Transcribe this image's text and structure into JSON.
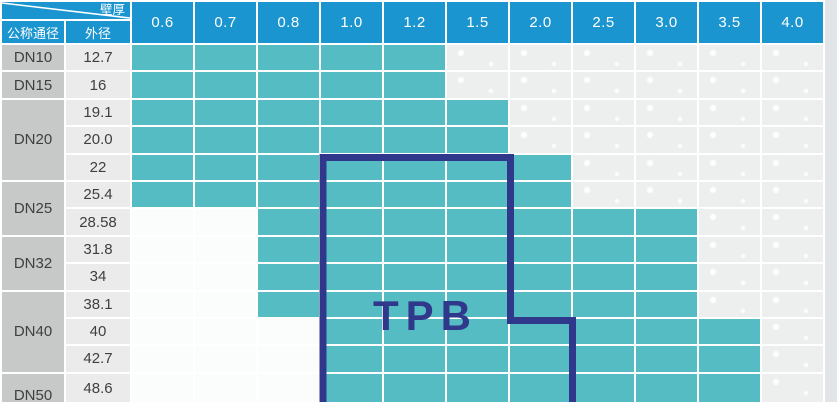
{
  "header": {
    "corner": {
      "diagonal_top_label": "壁厚",
      "col1_label": "公称通径",
      "col2_label": "外径"
    },
    "thickness_values": [
      "0.6",
      "0.7",
      "0.8",
      "1.0",
      "1.2",
      "1.5",
      "2.0",
      "2.5",
      "3.0",
      "3.5",
      "4.0"
    ]
  },
  "body": {
    "groups": [
      {
        "dn": "DN10",
        "rows": [
          {
            "od": "12.7",
            "available_from": "0.6",
            "available_to": "1.2"
          }
        ]
      },
      {
        "dn": "DN15",
        "rows": [
          {
            "od": "16",
            "available_from": "0.6",
            "available_to": "1.2"
          }
        ]
      },
      {
        "dn": "DN20",
        "rows": [
          {
            "od": "19.1",
            "available_from": "0.6",
            "available_to": "1.5"
          },
          {
            "od": "20.0",
            "available_from": "0.6",
            "available_to": "1.5"
          },
          {
            "od": "22",
            "available_from": "0.6",
            "available_to": "2.0"
          }
        ]
      },
      {
        "dn": "DN25",
        "rows": [
          {
            "od": "25.4",
            "available_from": "0.6",
            "available_to": "2.0"
          },
          {
            "od": "28.58",
            "available_from": "0.8",
            "available_to": "3.0"
          }
        ]
      },
      {
        "dn": "DN32",
        "rows": [
          {
            "od": "31.8",
            "available_from": "0.8",
            "available_to": "3.0"
          },
          {
            "od": "34",
            "available_from": "0.8",
            "available_to": "3.0"
          }
        ]
      },
      {
        "dn": "DN40",
        "rows": [
          {
            "od": "38.1",
            "available_from": "0.8",
            "available_to": "3.0"
          },
          {
            "od": "40",
            "available_from": "1.0",
            "available_to": "3.5"
          },
          {
            "od": "42.7",
            "available_from": "1.0",
            "available_to": "3.5"
          }
        ]
      },
      {
        "dn": "DN50",
        "rows": [
          {
            "od": "48.6",
            "available_from": "1.0",
            "available_to": "3.5"
          }
        ]
      }
    ]
  },
  "overlay": {
    "label": "TPB"
  },
  "colors": {
    "header_blue": "#1b95d0",
    "available_teal": "#56bcc4",
    "overlay_navy": "#2f388b",
    "dn_cell_gray": "#c7c8c8",
    "od_cell_gray": "#ebebeb"
  }
}
